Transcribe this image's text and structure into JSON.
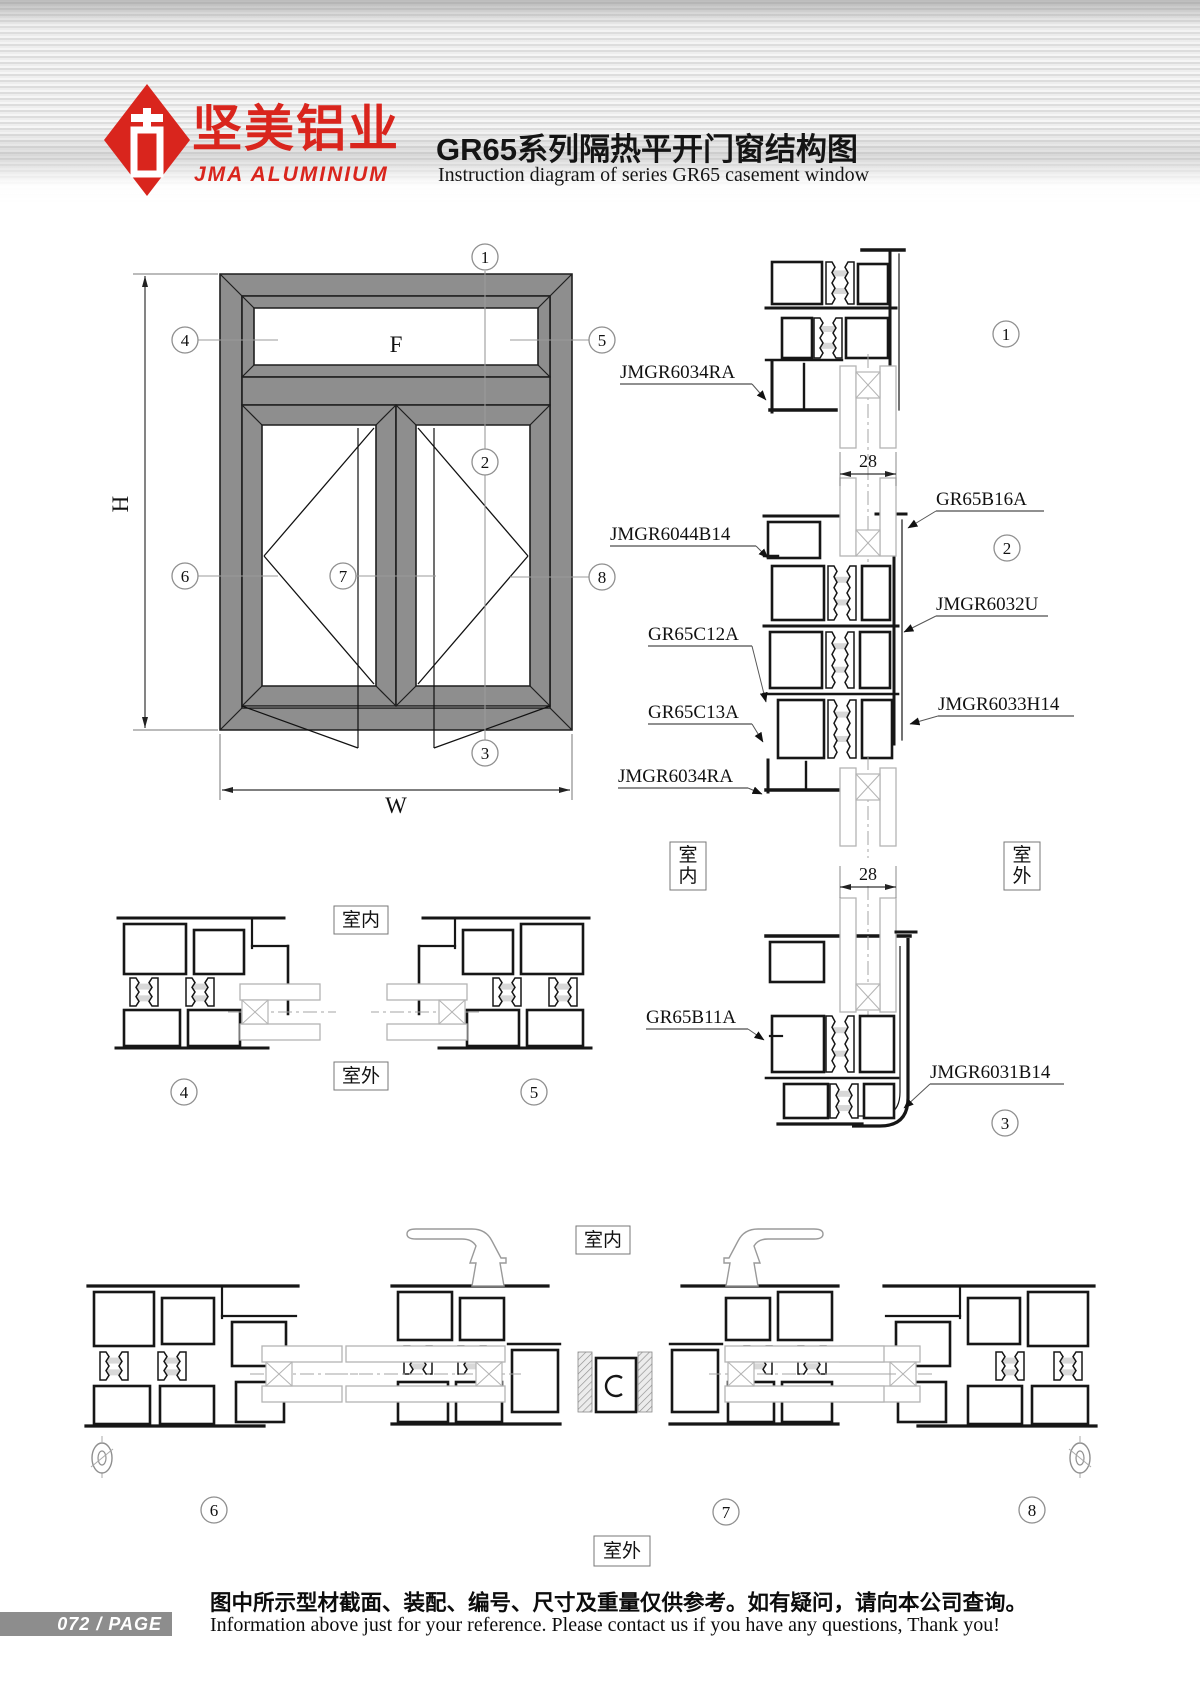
{
  "header": {
    "brand_cn": "坚美铝业",
    "brand_en": "JMA ALUMINIUM",
    "title_cn": "GR65系列隔热平开门窗结构图",
    "title_en": "Instruction diagram of series GR65 casement window"
  },
  "elevation": {
    "fixed_label": "F",
    "height_label": "H",
    "width_label": "W"
  },
  "callouts": {
    "c1": "1",
    "c2": "2",
    "c3": "3",
    "c4": "4",
    "c5": "5",
    "c6": "6",
    "c7": "7",
    "c8": "8"
  },
  "parts": {
    "d1_frame_top": "JMGR6034RA",
    "d2_sash_top": "JMGR6044B14",
    "d2_bead": "GR65B16A",
    "d2_mullion": "JMGR6032U",
    "d2_transom_upper": "GR65C12A",
    "d2_sash_lower": "JMGR6033H14",
    "d2_transom_lower": "GR65C13A",
    "d2_frame_bottom": "JMGR6034RA",
    "d3_bead": "GR65B11A",
    "d3_frame_sill": "JMGR6031B14"
  },
  "dims": {
    "glass_width": "28"
  },
  "room": {
    "indoor": "室内",
    "outdoor": "室外"
  },
  "footer": {
    "page_badge": "072 / PAGE",
    "note_cn": "图中所示型材截面、装配、编号、尺寸及重量仅供参考。如有疑问，请向本公司查询。",
    "note_en": "Information above just for your reference. Please contact us if you have any questions, Thank you!"
  }
}
